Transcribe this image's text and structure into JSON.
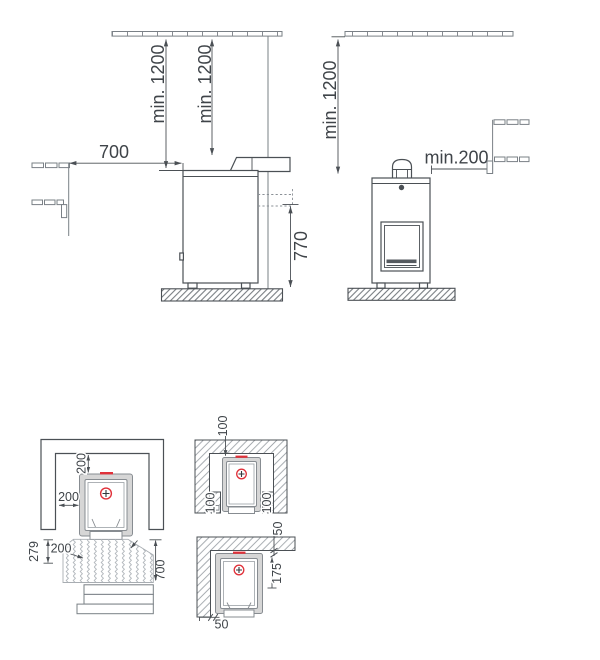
{
  "drawing": {
    "title": "stove-installation-safety-distances",
    "colors": {
      "line": "#4b5055",
      "accent": "#e0313a"
    },
    "side_left": {
      "flue_ceiling": "min. 1200",
      "stove_ceiling": "min. 1200",
      "bench": "700",
      "height": "770"
    },
    "side_right": {
      "ceiling": "min. 1200",
      "bench": "min.200"
    },
    "plan_main": {
      "rear": "200",
      "side": "200",
      "front_left": "279",
      "front": "200",
      "front_depth": "700"
    },
    "plan_alcove": {
      "rear": "100",
      "left": "100",
      "right": "100"
    },
    "plan_corner": {
      "rear": "50",
      "offset": "175",
      "side": "50"
    }
  }
}
